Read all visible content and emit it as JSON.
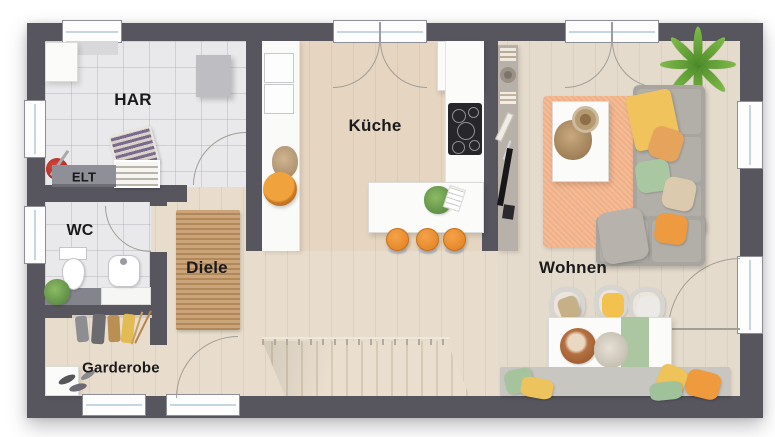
{
  "labels": {
    "har": "HAR",
    "elt": "ELT",
    "wc": "WC",
    "diele": "Diele",
    "garderobe": "Garderobe",
    "kueche": "Küche",
    "wohnen": "Wohnen"
  },
  "colors": {
    "wall": "#57565e",
    "tile_floor": "#e9e9eb",
    "wood_floor": "#e8ddcc",
    "rug_jute": "#c79d6e",
    "rug_orange": "#f1af85",
    "sofa_gray": "#a8a5a0",
    "stool_orange": "#f08c28",
    "accent_yellow": "#f1c35c",
    "accent_green": "#a9c8a2"
  }
}
